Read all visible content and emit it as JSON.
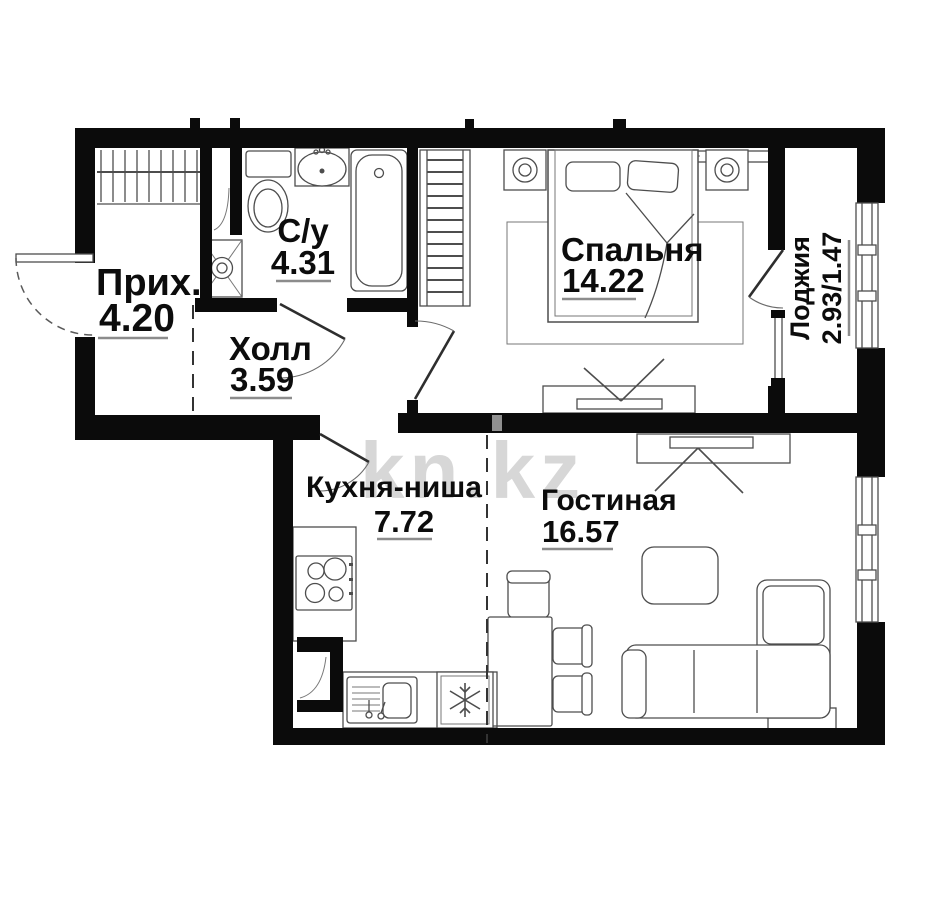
{
  "title": "Планировка 1-комнатной квартиры",
  "watermark": {
    "text": "kn.kz"
  },
  "rooms": [
    {
      "id": "hallway",
      "name": "Прих.",
      "area": "4.20"
    },
    {
      "id": "bathroom",
      "name": "С/у",
      "area": "4.31"
    },
    {
      "id": "hall",
      "name": "Холл",
      "area": "3.59"
    },
    {
      "id": "bedroom",
      "name": "Спальня",
      "area": "14.22"
    },
    {
      "id": "loggia",
      "name": "Лоджия",
      "area": "2.93/1.47"
    },
    {
      "id": "kitchen",
      "name": "Кухня-ниша",
      "area": "7.72"
    },
    {
      "id": "living",
      "name": "Гостиная",
      "area": "16.57"
    }
  ],
  "colors": {
    "wall": "#0b0b0b",
    "furniture": "#4d4d4d",
    "background": "#ffffff",
    "watermark": "#d7d7d7",
    "underline": "#8c8c8c"
  }
}
